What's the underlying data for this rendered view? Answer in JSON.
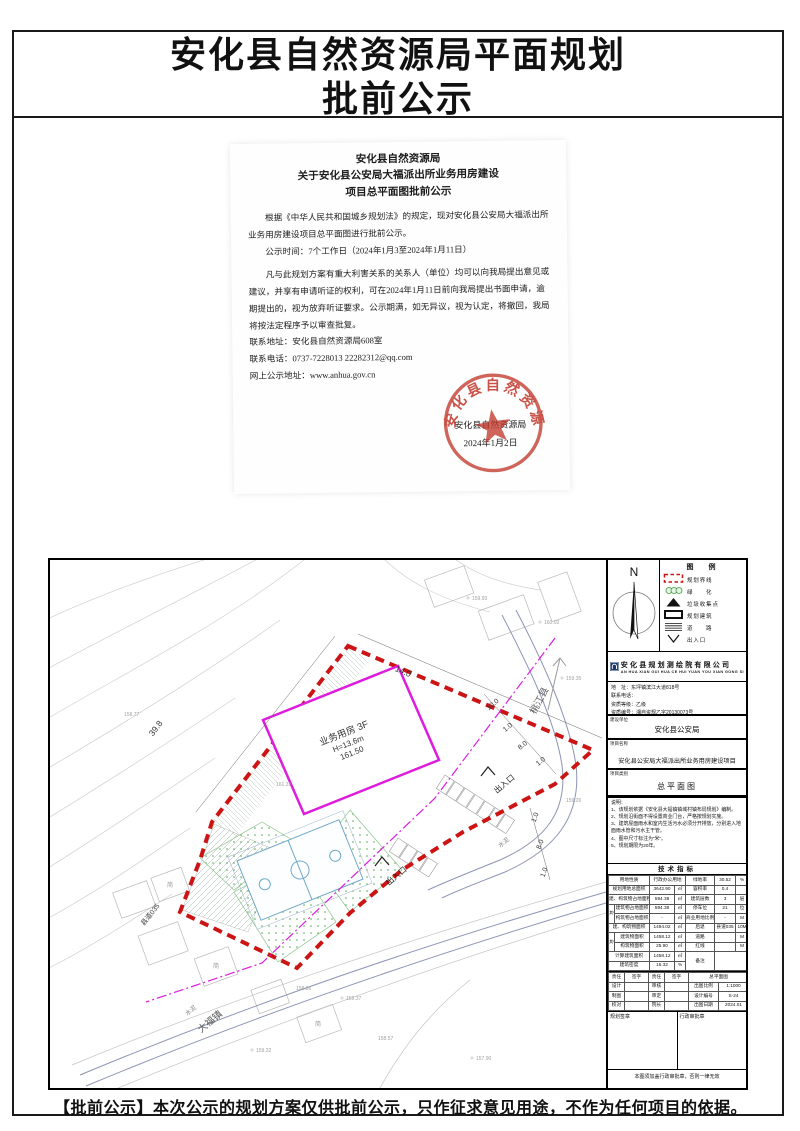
{
  "page": {
    "title_line1": "安化县自然资源局平面规划",
    "title_line2": "批前公示",
    "footer_notice": "【批前公示】本次公示的规划方案仅供批前公示，只作征求意见用途，不作为任何项目的依据。"
  },
  "notice": {
    "header1": "安化县自然资源局",
    "header2": "关于安化县公安局大福派出所业务用房建设",
    "header3": "项目总平面图批前公示",
    "para1": "根据《中华人民共和国城乡规划法》的规定，现对安化县公安局大福派出所业务用房建设项目总平面图进行批前公示。",
    "para2": "公示时间：7个工作日（2024年1月3至2024年1月11日）",
    "para3": "凡与此规划方案有重大利害关系的关系人（单位）均可以向我局提出意见或建议，并享有申请听证的权利，可在2024年1月11日前向我局提出书面申请，逾期提出的，视为放弃听证要求。公示期满，如无异议，视为认定，将撤回，我局将按法定程序予以审查批复。",
    "addr": "联系地址：安化县自然资源局608室",
    "phone": "联系电话：0737-7228013      22282312@qq.com",
    "web": "网上公示地址：www.anhua.gov.cn",
    "authority": "安化县自然资源局",
    "date": "2024年1月2日",
    "seal_text": "安化县自然资源局"
  },
  "panel": {
    "north": "N",
    "legend_title": "图　例",
    "legend": [
      {
        "label": "规划界线"
      },
      {
        "label": "绿　　化"
      },
      {
        "label": "垃圾收集点"
      },
      {
        "label": "规划建筑"
      },
      {
        "label": "道　　路"
      },
      {
        "label": "出入口"
      }
    ],
    "company": {
      "name": "安化县规划测绘院有限公司",
      "pinyin": "AN HUA XIAN GUI HUA CE HUI YUAN YOU XIAN GONG SI",
      "addr": "地　址：东坪镇滨江大道818号",
      "phone": "联系电话：",
      "grade": "资质等级：乙级",
      "cert": "资质编号：湘自资规乙字20130073号"
    },
    "owner_label": "建设单位",
    "owner": "安化县公安局",
    "project_label": "项目名称",
    "project": "安化县公安局大福派出所业务用房建设项目",
    "type_label": "项目类别",
    "type": "总平面图",
    "notes_title": "说明：",
    "notes": [
      "1、该规划依据《安化县大福镇镇域村镇布局规划》编制。",
      "2、规划沿街面不得设置商业门台，严格按规划实施。",
      "3、建筑屋面雨水和室内生活污水必须分开排放，分别进入地面雨水管和污水主干管。",
      "4、图中尺寸标注为“米”。",
      "5、规划期限为20年。"
    ],
    "tech_title": "技术指标",
    "tech": {
      "r1": [
        "用地性质",
        "行政办公用地",
        "绿地率",
        "30.52",
        "%"
      ],
      "r2": [
        "规划用地总面积",
        "3642.90",
        "㎡",
        "容积率",
        "0.4",
        ""
      ],
      "r3": [
        "建、构筑物占地面积",
        "594.38",
        "㎡",
        "建筑层数",
        "3",
        "层"
      ],
      "qz1": "其中",
      "r4": [
        "建筑物占地面积",
        "594.38",
        "㎡",
        "停车位",
        "21",
        "位"
      ],
      "r5": [
        "构筑物占地面积",
        "-",
        "㎡",
        "商业用地比例",
        "-",
        "M"
      ],
      "r6": [
        "建、构筑物面积",
        "1494.02",
        "㎡",
        "后退",
        "县道035",
        "10M"
      ],
      "qz2": "其中",
      "r7": [
        "建筑物面积",
        "1458.12",
        "㎡",
        "道路",
        "",
        "M"
      ],
      "r8": [
        "构筑物面积",
        "25.90",
        "㎡",
        "红线",
        "",
        "M"
      ],
      "r9": [
        "计算建筑面积",
        "1458.12",
        "㎡",
        "备注"
      ],
      "r10": [
        "建筑密度",
        "16.32",
        "%"
      ]
    },
    "sign": {
      "h": [
        "责任",
        "签字",
        "责任",
        "签字",
        "总平面图"
      ],
      "rows": [
        [
          "设计",
          "",
          "审核",
          "",
          "出图比例",
          "1:1000"
        ],
        [
          "制图",
          "",
          "审定",
          "",
          "设计编号",
          "S-24"
        ],
        [
          "校对",
          "",
          "院长",
          "",
          "出图日期",
          "2024.01"
        ]
      ]
    },
    "stamp_left": "规划签章",
    "stamp_right": "行政审批章",
    "foot_note": "本图须加盖行政审批章，否则一律无效"
  },
  "drawing": {
    "building1": "业务用房 3F",
    "building2": "H=13.6m",
    "building3": "161.50",
    "dim1": "39.8",
    "dim2": "14.0",
    "chain_a": [
      "10.0",
      "1.0",
      "8.0",
      "1.0"
    ],
    "chain_b": [
      "1.0",
      "8.0",
      "1.0"
    ],
    "entrance": "出入口",
    "road1": "大福镇",
    "road2": "桃江县",
    "road3": "县道035",
    "cement": "水泥",
    "shed": "简",
    "elev": [
      "160.02",
      "159.93",
      "159.35",
      "159.26",
      "158.77",
      "159.37",
      "158.57",
      "157.90",
      "159.32",
      "158.86",
      "161.31"
    ]
  },
  "colors": {
    "boundary_red": "#cc1414",
    "building_magenta": "#dd1cdd",
    "green": "#55a855",
    "seal_red": "#c23b2f",
    "road_blue": "#8d94b5"
  }
}
